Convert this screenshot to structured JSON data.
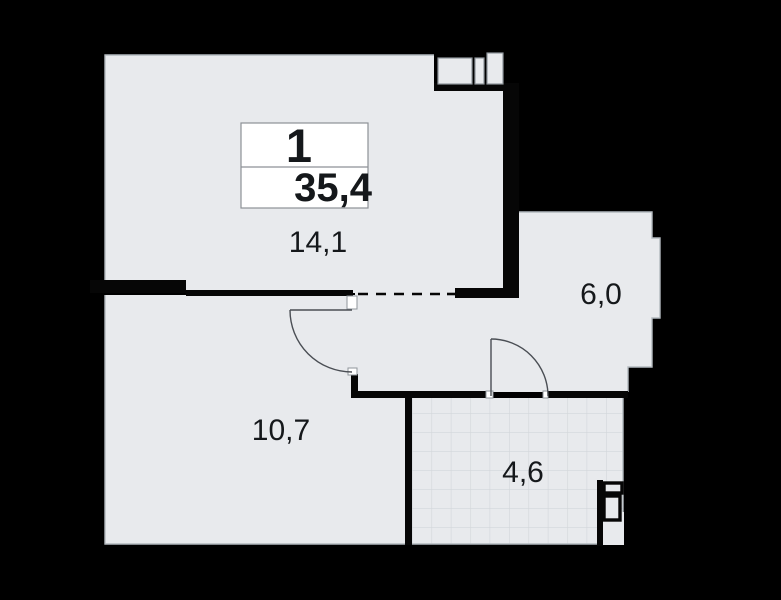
{
  "plan": {
    "unit_box": {
      "rooms_count": "1",
      "total_area": "35,4"
    },
    "rooms": [
      {
        "name": "living-room",
        "area": "14,1"
      },
      {
        "name": "kitchen",
        "area": "6,0"
      },
      {
        "name": "bedroom",
        "area": "10,7"
      },
      {
        "name": "bathroom",
        "area": "4,6"
      }
    ],
    "fixtures": [
      {
        "icon": "window-unit-icon"
      },
      {
        "icon": "door-swing-icon"
      },
      {
        "icon": "door-swing-icon"
      },
      {
        "icon": "dashed-opening-icon"
      },
      {
        "icon": "duct-shaft-icon"
      },
      {
        "icon": "tiled-floor-icon"
      }
    ]
  },
  "colors": {
    "bg": "#000000",
    "room-fill": "#e8eaed",
    "wall": "#060606",
    "outline": "#8f959b",
    "jamb-fill": "#ffffff",
    "door": "#4a4e54",
    "tile-line": "#d2d6da",
    "text": "#15181b",
    "box-fill": "#ffffff",
    "box-border": "#8d9196",
    "floor-edge": "#b3b9bf"
  }
}
